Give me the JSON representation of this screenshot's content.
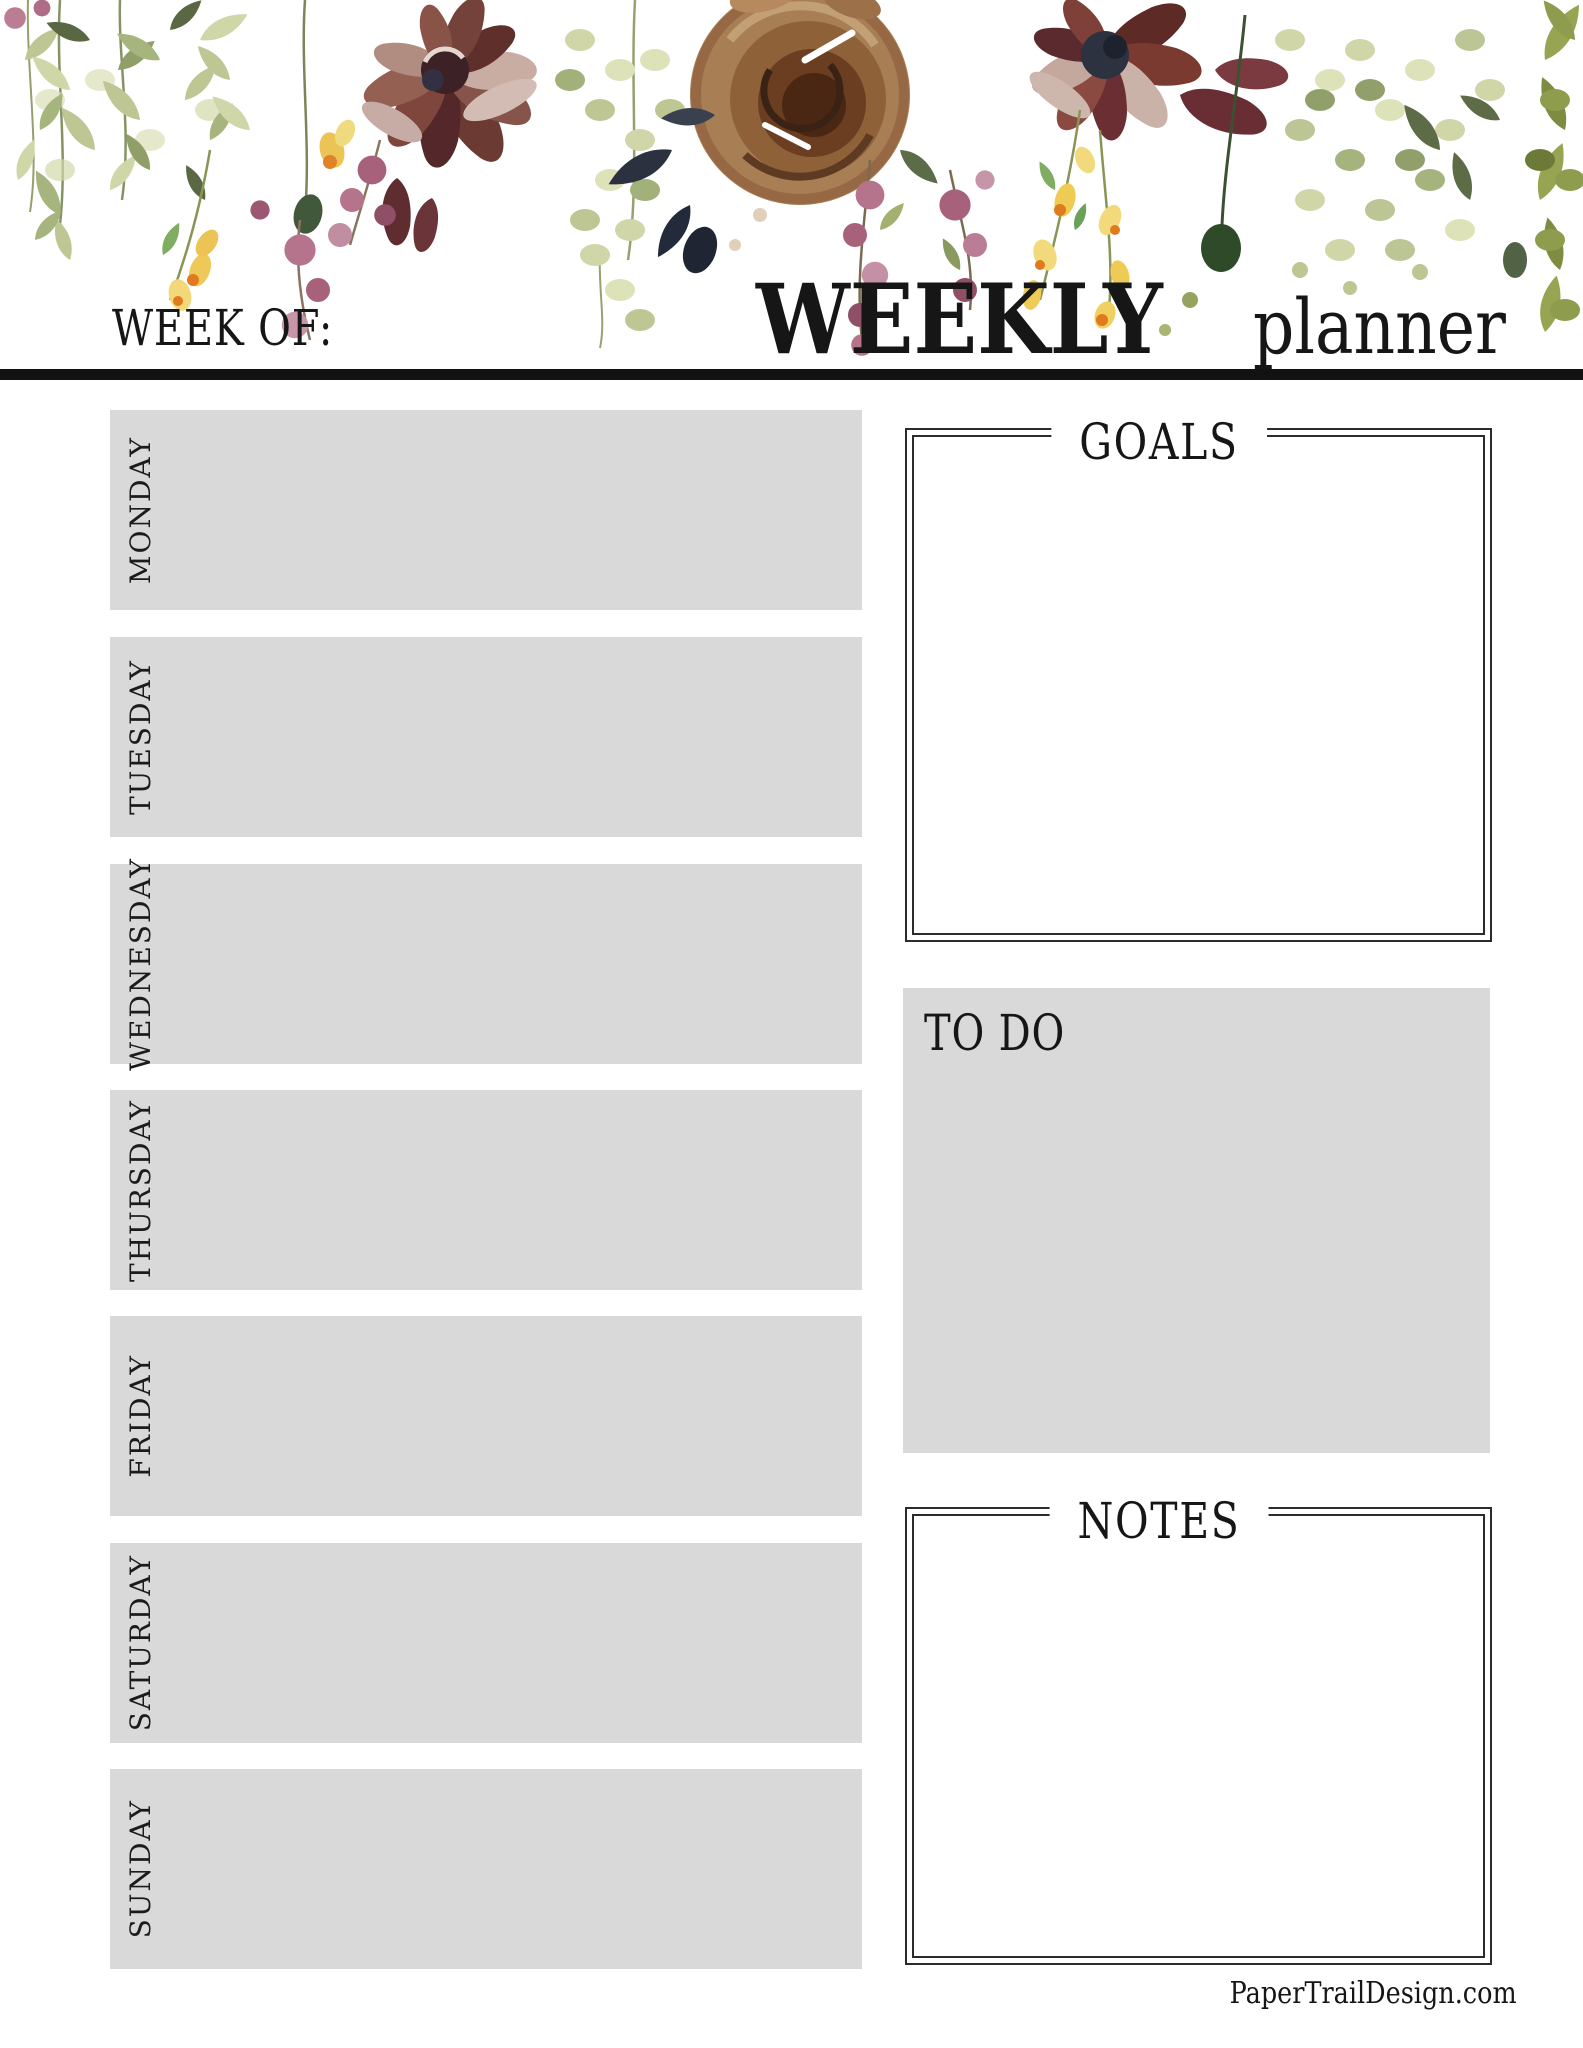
{
  "header": {
    "week_of_label": "WEEK OF:",
    "title_primary": "WEEKLY",
    "title_secondary": "planner"
  },
  "days": [
    "MONDAY",
    "TUESDAY",
    "WEDNESDAY",
    "THURSDAY",
    "FRIDAY",
    "SATURDAY",
    "SUNDAY"
  ],
  "sections": {
    "goals": {
      "title": "GOALS"
    },
    "todo": {
      "title": "TO DO"
    },
    "notes": {
      "title": "NOTES"
    }
  },
  "footer": {
    "credit": "PaperTrailDesign.com"
  },
  "illustration": {
    "name": "watercolor-floral-header-border",
    "palette": {
      "sage_green_light": "#ccd29e",
      "sage_green": "#a8b478",
      "olive_dark": "#4c5c33",
      "olive_right_edge": "#97a452",
      "burgundy": "#6b3a33",
      "maroon_deep": "#54282a",
      "blush": "#c9ada3",
      "navy_accent": "#2d3240",
      "rose_tan": "#a87e55",
      "rose_brown_core": "#4a2713",
      "berry_mauve": "#a8617a",
      "berry_pink": "#c490a5",
      "yellow_flower": "#eecb55",
      "orange_accent": "#e07a1e"
    }
  },
  "surface_colors": {
    "day_box_gray": "#d9d9d9",
    "frame_border": "#2b2b2b",
    "rule_black": "#121212",
    "page_white": "#ffffff"
  }
}
